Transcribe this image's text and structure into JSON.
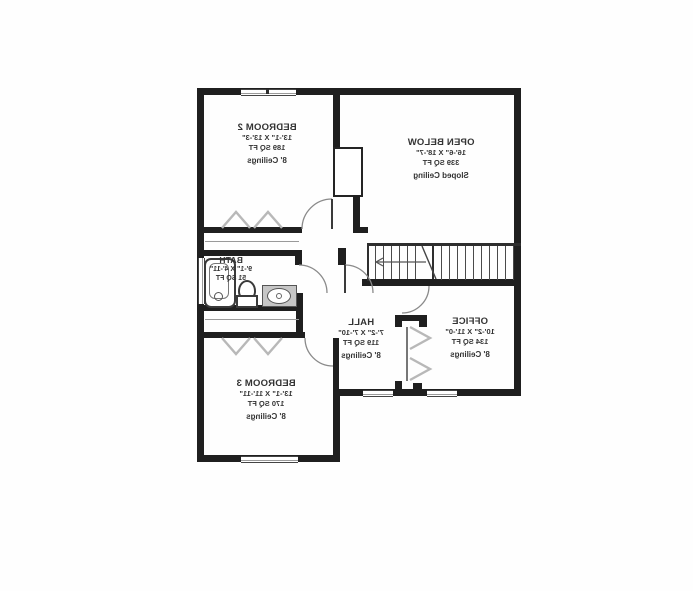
{
  "floorplan": {
    "orientation": "mirrored",
    "rooms": [
      {
        "name": "BEDROOM 2",
        "dimensions": "13'-1\" X 13'-3\"",
        "area": "189 SQ FT",
        "ceiling": "8' Ceilings"
      },
      {
        "name": "OPEN BELOW",
        "dimensions": "16'-6\" X 18'-7\"",
        "area": "339 SQ FT",
        "ceiling": "Sloped Ceiling"
      },
      {
        "name": "BATH",
        "dimensions": "9'-1\" X 4'-11\"",
        "area": "51 SQ FT"
      },
      {
        "name": "HALL",
        "dimensions": "7'-2\" X 7'-10\"",
        "area": "119 SQ FT",
        "ceiling": "8' Ceilings"
      },
      {
        "name": "OFFICE",
        "dimensions": "10'-2\" X 11'-0\"",
        "area": "134 SQ FT",
        "ceiling": "8' Ceilings"
      },
      {
        "name": "BEDROOM 3",
        "dimensions": "13'-1\" X 11'-11\"",
        "area": "170 SQ FT",
        "ceiling": "8' Ceilings"
      }
    ],
    "symbols": {
      "door_arc": "quarter-circle swing",
      "closet_doors": "chevron marks",
      "stairs": "parallel treads with direction arrow",
      "windows": "double-line wall gaps"
    },
    "colors": {
      "wall": "#1f1f1f",
      "text": "#333333",
      "chevron": "#b8b8b8",
      "vanity_counter": "#c6c6c6"
    }
  }
}
